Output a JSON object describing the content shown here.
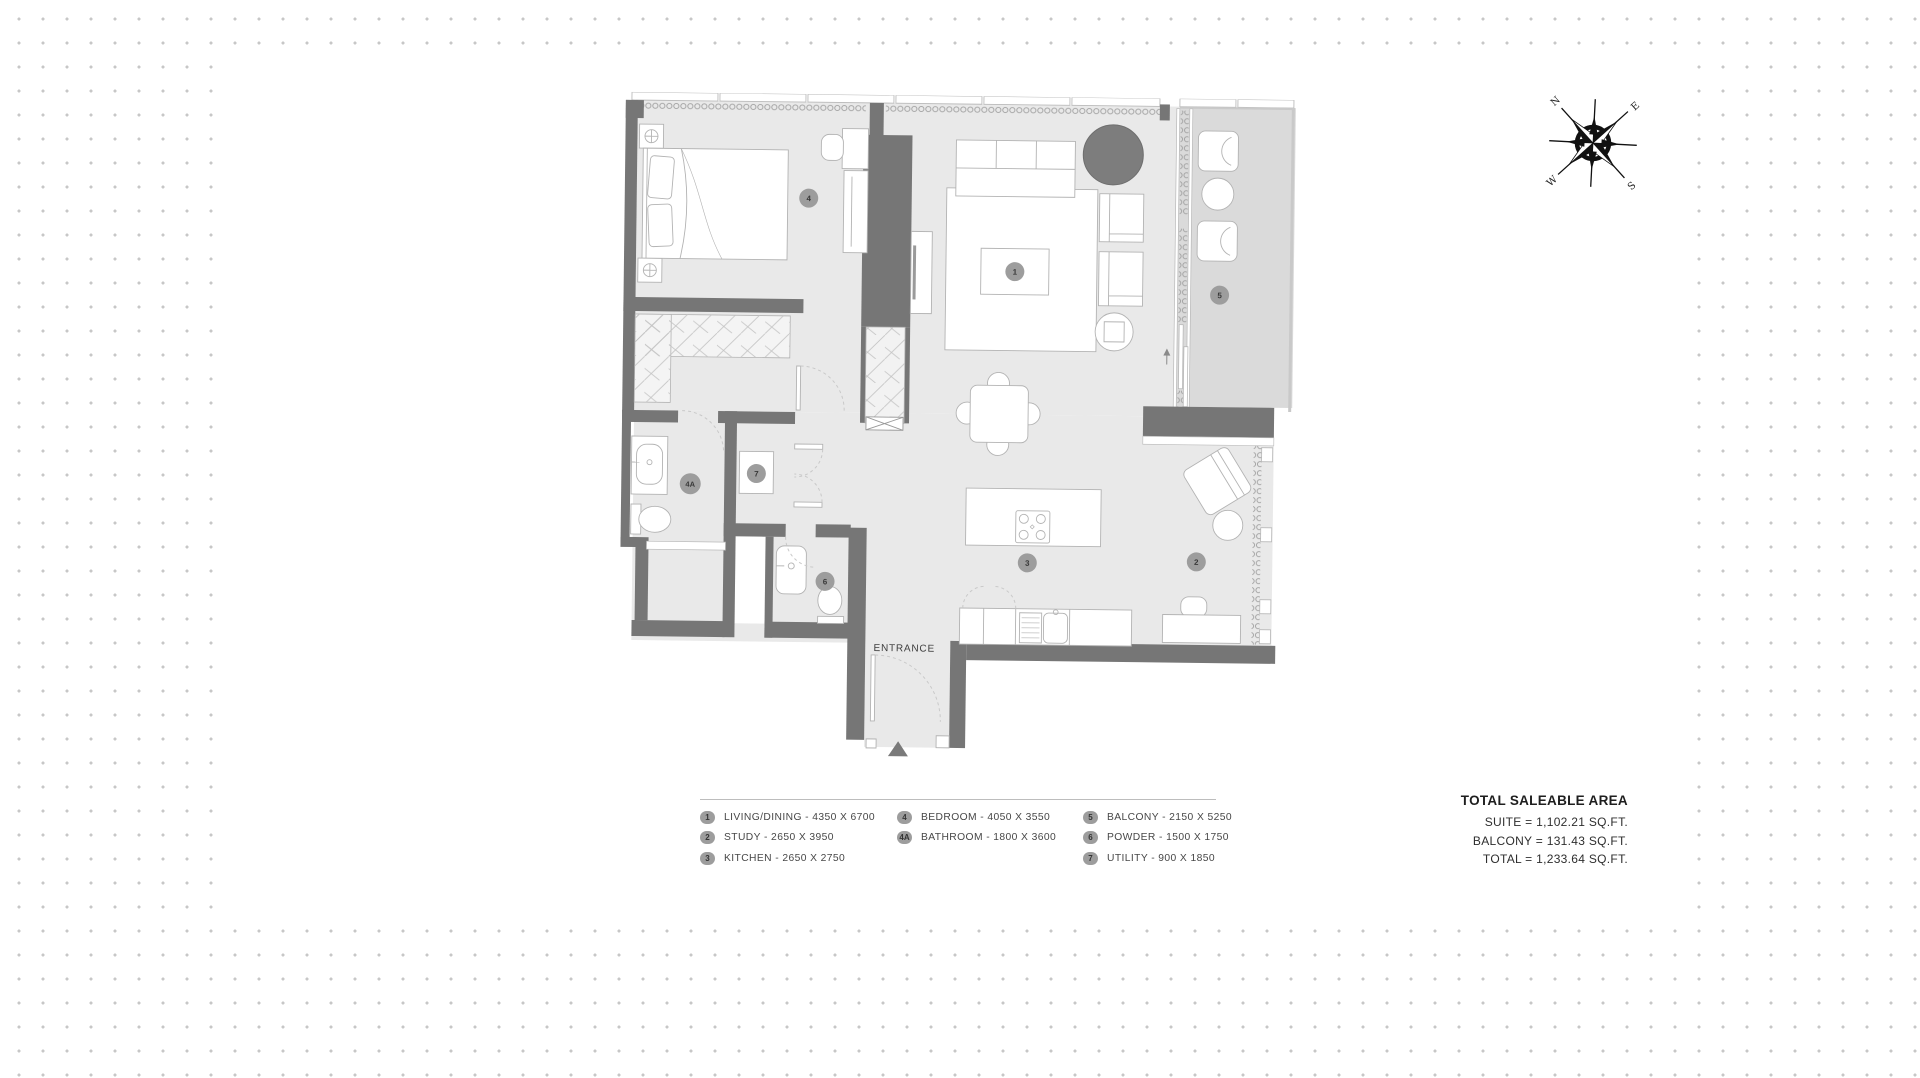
{
  "colors": {
    "wall": "#767676",
    "floor": "#e9e9e9",
    "balcony_floor": "#dadada",
    "furniture_stroke": "#b3b3b3",
    "badge_fill": "#9d9d9d",
    "dark_accent": "#7d7d7d",
    "dot_grid": "#c7c7c7"
  },
  "compass": {
    "n": "N",
    "e": "E",
    "s": "S",
    "w": "W"
  },
  "floor_plan": {
    "entrance_label": "ENTRANCE",
    "room_badges": {
      "living": "1",
      "study": "2",
      "kitchen": "3",
      "bedroom": "4",
      "bathroom": "4A",
      "balcony": "5",
      "powder": "6",
      "utility": "7"
    }
  },
  "legend": {
    "items": [
      {
        "badge": "1",
        "label": "LIVING/DINING - 4350 X 6700"
      },
      {
        "badge": "2",
        "label": "STUDY - 2650 X 3950"
      },
      {
        "badge": "3",
        "label": "KITCHEN - 2650 X 2750"
      },
      {
        "badge": "4",
        "label": "BEDROOM - 4050 X 3550"
      },
      {
        "badge": "4A",
        "label": "BATHROOM - 1800 X 3600"
      },
      {
        "badge": "5",
        "label": "BALCONY - 2150 X 5250"
      },
      {
        "badge": "6",
        "label": "POWDER - 1500 X 1750"
      },
      {
        "badge": "7",
        "label": "UTILITY - 900 X 1850"
      }
    ]
  },
  "area_summary": {
    "title": "TOTAL SALEABLE AREA",
    "lines": [
      "SUITE = 1,102.21 SQ.FT.",
      "BALCONY = 131.43 SQ.FT.",
      "TOTAL = 1,233.64 SQ.FT."
    ]
  }
}
